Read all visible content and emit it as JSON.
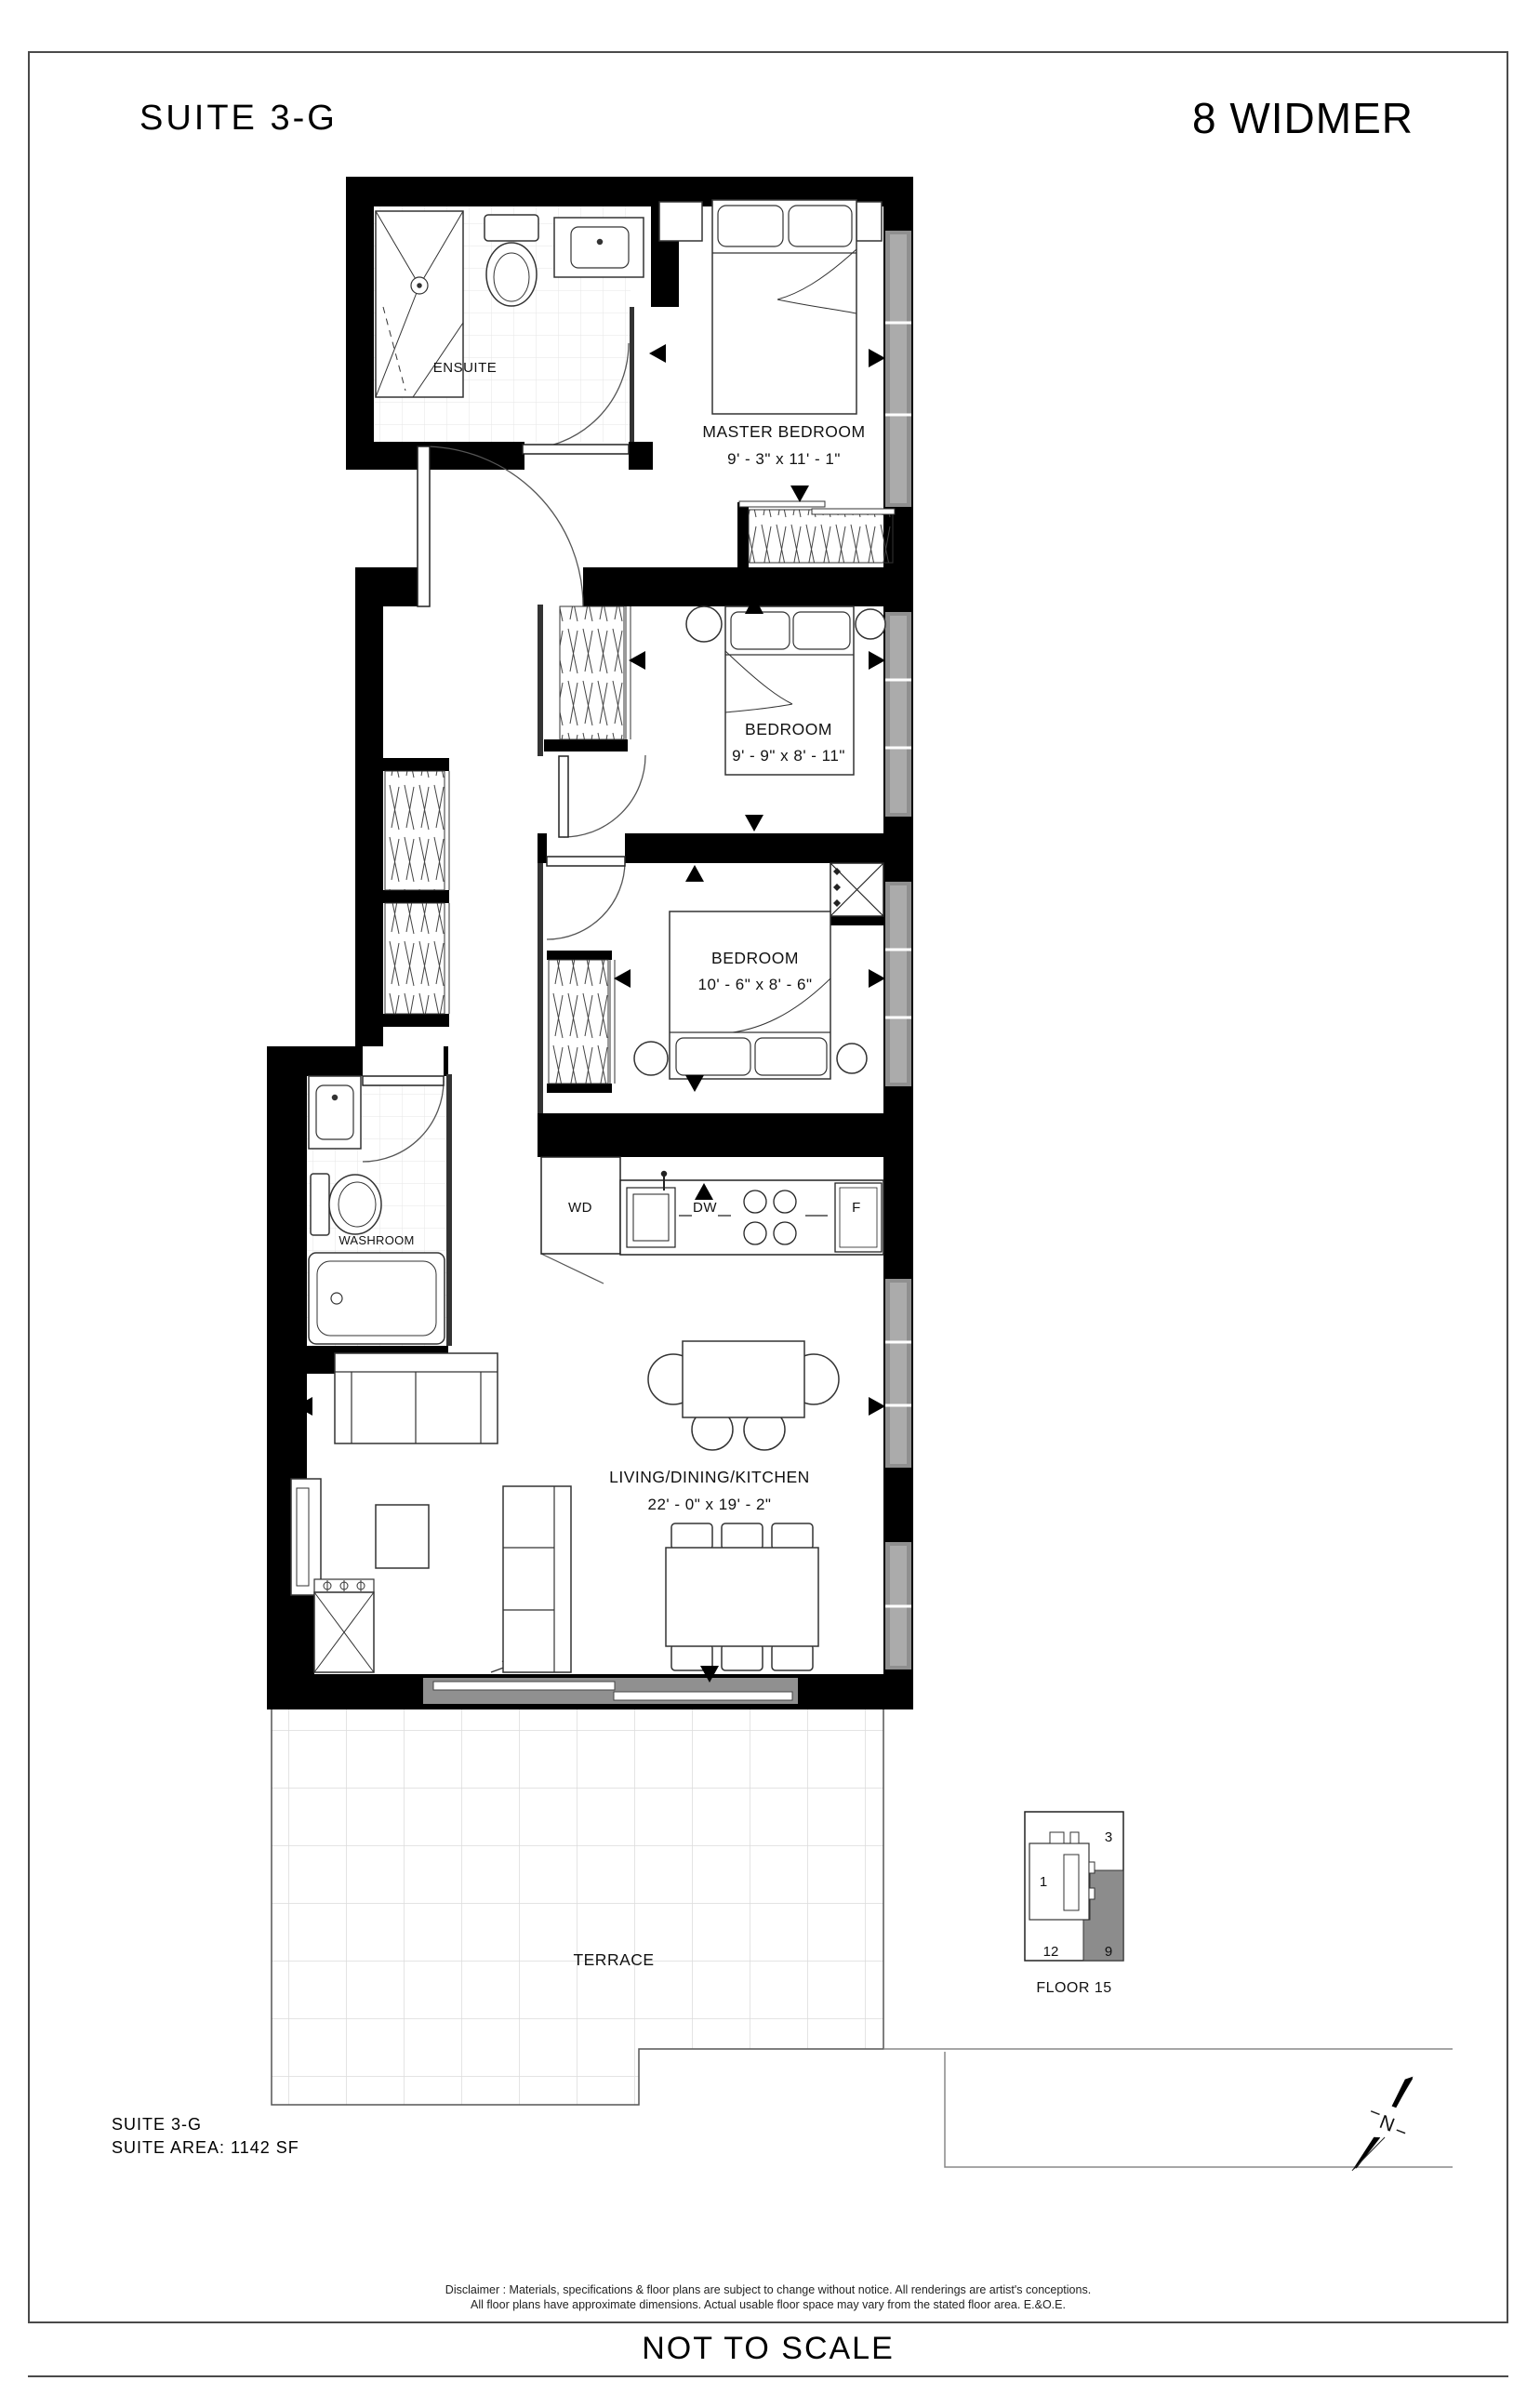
{
  "page": {
    "title_left": "SUITE  3-G",
    "title_right": "8 WIDMER",
    "not_to_scale": "NOT TO SCALE",
    "disclaimer_line1": "Disclaimer : Materials, specifications & floor plans are subject to change without notice. All renderings are artist's conceptions.",
    "disclaimer_line2": "All floor plans have approximate dimensions. Actual usable floor space may vary from the stated floor area. E.&O.E."
  },
  "suite_info": {
    "name": "SUITE  3-G",
    "area": "SUITE AREA:  1142 SF"
  },
  "rooms": {
    "ensuite": {
      "label": "ENSUITE"
    },
    "master": {
      "label": "MASTER BEDROOM",
      "dims": "9' - 3\"  x  11' - 1\""
    },
    "bedroom2": {
      "label": "BEDROOM",
      "dims": "9' - 9\"  x  8' - 11\""
    },
    "bedroom3": {
      "label": "BEDROOM",
      "dims": "10' - 6\"  x  8' - 6\""
    },
    "washroom": {
      "label": "WASHROOM"
    },
    "living": {
      "label": "LIVING/DINING/KITCHEN",
      "dims": "22' - 0\"  x  19' - 2\""
    },
    "terrace": {
      "label": "TERRACE"
    }
  },
  "appliances": {
    "washer_dryer": "WD",
    "dishwasher": "DW",
    "fridge": "F"
  },
  "keyplan": {
    "floor_label": "FLOOR 15",
    "unit_top_right": "3",
    "unit_left": "1",
    "unit_bottom_left": "12",
    "unit_bottom_right": "9",
    "highlighted_unit": "9",
    "highlight_color": "#8c8c8c"
  },
  "compass": {
    "north_label": "N"
  },
  "colors": {
    "wall": "#000000",
    "window": "#8f8f8f",
    "accent_gray": "#8c8c8c"
  }
}
